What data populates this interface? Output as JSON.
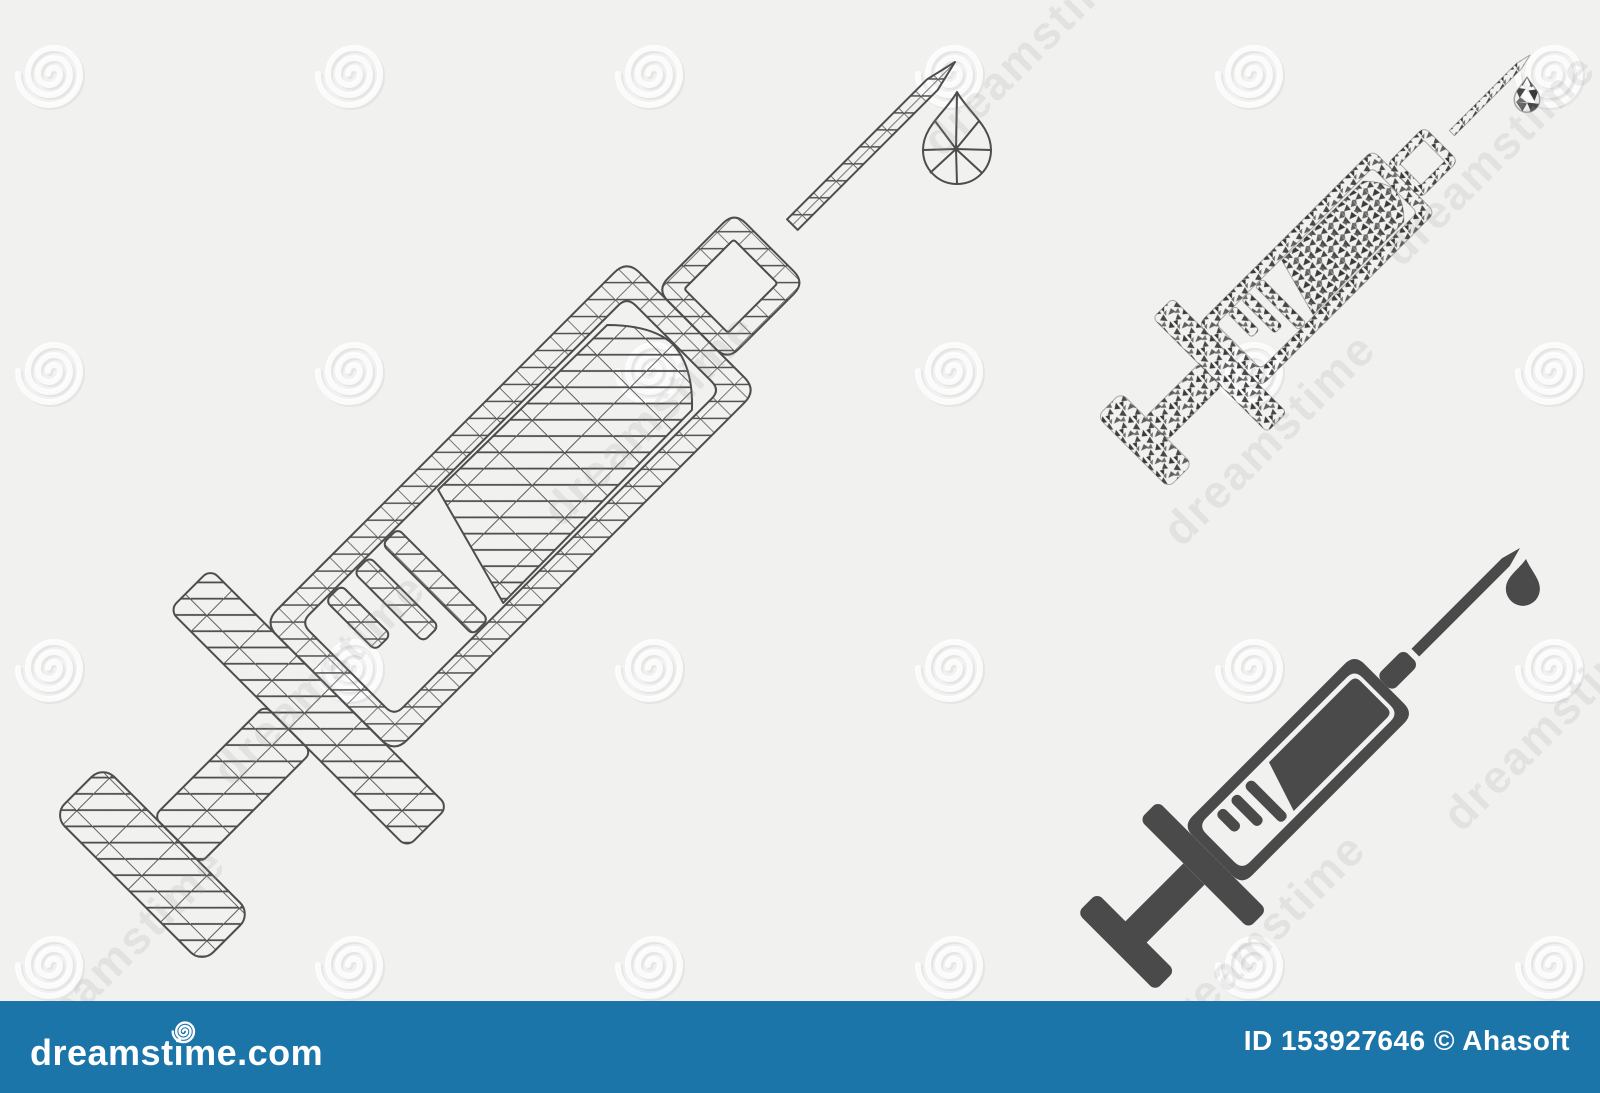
{
  "watermark": {
    "text": "dreamstime",
    "spiral_icon": "spiral-icon"
  },
  "footer": {
    "logo_text": "dreamstime.com",
    "logo_icon": "dreamstime-spiral-logo-icon",
    "credit": "ID 153927646 © Ahasoft"
  },
  "icons": {
    "left": "mesh-syringe-icon",
    "top_right": "mosaic-syringe-icon",
    "bottom_right": "solid-syringe-icon",
    "droplet": "droplet-icon"
  },
  "colors": {
    "bg": "#f1f1f0",
    "line": "#4d4d4d",
    "icon": "#4a4a4a",
    "bar": "#1b75a8",
    "white": "#ffffff",
    "m1": "#474747",
    "m2": "#5f5f5f",
    "m3": "#3a3a3a",
    "m4": "#6e6e6e",
    "wm_text": "#9a9a9a"
  }
}
